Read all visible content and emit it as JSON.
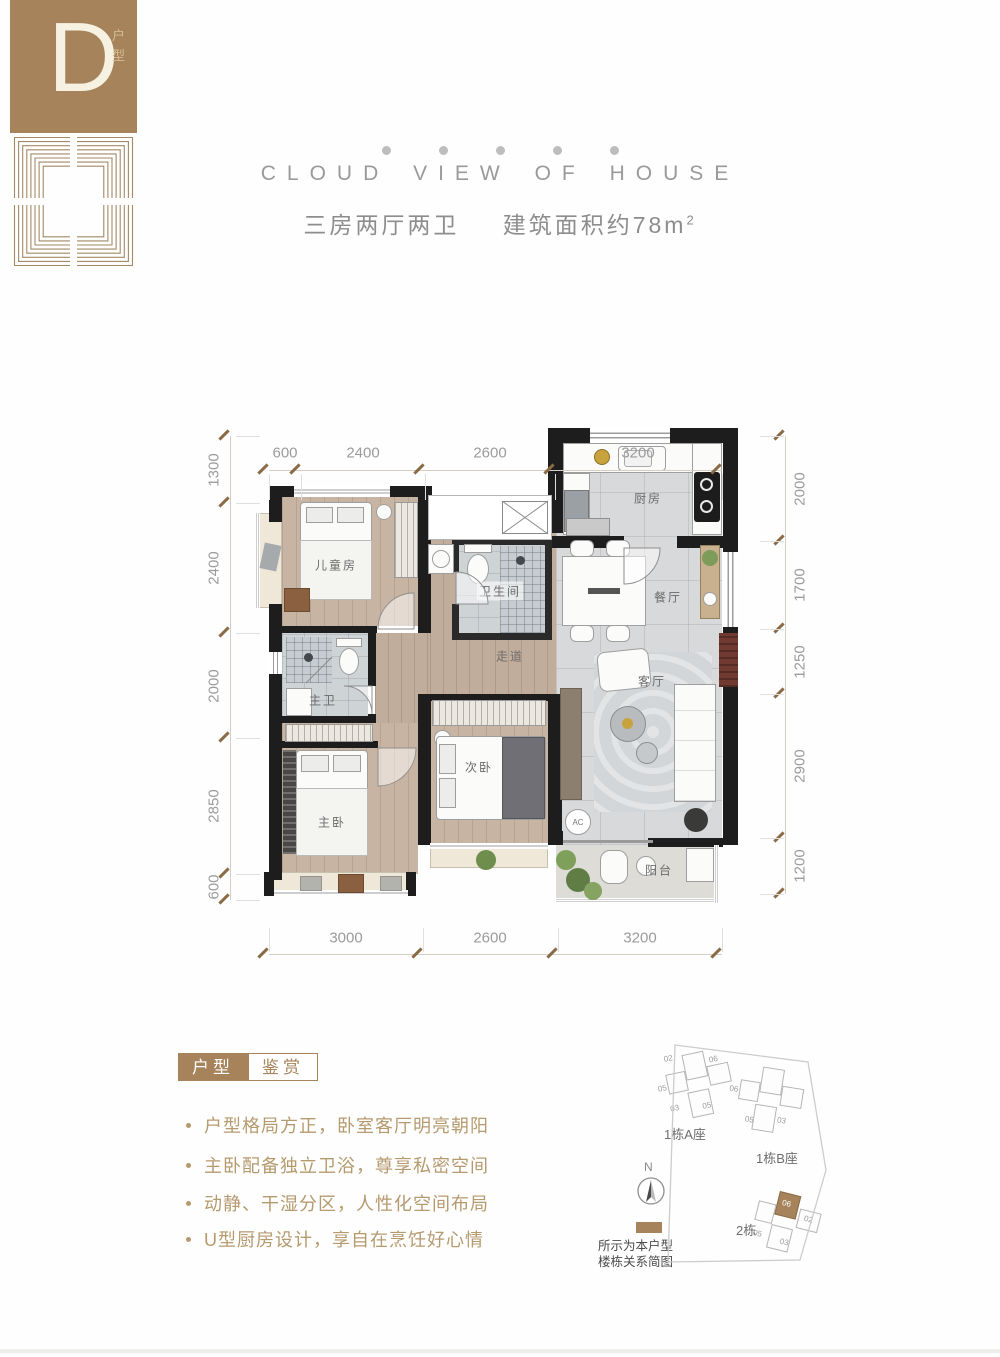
{
  "brand": {
    "letter": "D",
    "label": "户型"
  },
  "header": {
    "title": "CLOUD VIEW OF HOUSE",
    "subtitle_left": "三房两厅两卫",
    "subtitle_right": "建筑面积约78m",
    "subtitle_sup": "2"
  },
  "floorplan": {
    "rooms": [
      "厨房",
      "餐厅",
      "卫生间",
      "走道",
      "客厅",
      "儿童房",
      "主卫",
      "次卧",
      "主卧",
      "阳台"
    ],
    "ac_label": "AC",
    "dim_top": [
      "600",
      "2400",
      "2600",
      "3200"
    ],
    "dim_bottom": [
      "3000",
      "2600",
      "3200"
    ],
    "dim_left": [
      "1300",
      "2400",
      "2000",
      "2850",
      "600"
    ],
    "dim_right": [
      "2000",
      "1700",
      "1250",
      "2900",
      "1200"
    ]
  },
  "features": {
    "tag_primary": "户型",
    "tag_secondary": "鉴赏",
    "items": [
      "户型格局方正，卧室客厅明亮朝阳",
      "主卧配备独立卫浴，尊享私密空间",
      "动静、干湿分区，人性化空间布局",
      "U型厨房设计，享自在烹饪好心情"
    ]
  },
  "sitemap": {
    "north_label": "N",
    "buildings": [
      {
        "label": "1栋A座",
        "units": [
          "02",
          "05",
          "06",
          "03",
          "05"
        ]
      },
      {
        "label": "1栋B座",
        "units": [
          "06",
          "05",
          "03"
        ]
      },
      {
        "label": "2栋",
        "units": [
          "06",
          "02",
          "05",
          "03"
        ],
        "highlighted_unit": "06"
      }
    ],
    "legend_line1": "所示为本户型",
    "legend_line2": "楼栋关系简图"
  },
  "colors": {
    "accent": "#a6835a",
    "wall": "#1d1d1d",
    "wood": "#c8b4a2",
    "tile": "#d8d9da",
    "cream": "#efe8d8",
    "feature_text": "#b59a6e",
    "dim_tick": "#8a6a45",
    "red_cabinet": "#713a30"
  }
}
